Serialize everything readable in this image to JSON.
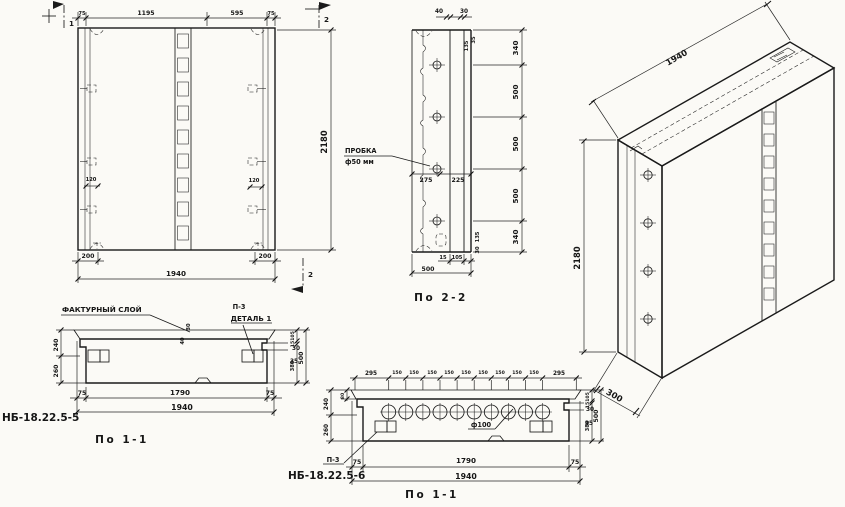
{
  "front_view": {
    "dims_top": [
      "75",
      "1195",
      "595",
      "75"
    ],
    "height": "2180",
    "dim_200_left": "200",
    "dim_total": "1940",
    "dim_200_right": "200",
    "dim_120_left": "120",
    "dim_120_right": "120",
    "flag_1": "1",
    "flag_2_top": "2",
    "flag_2_bottom": "2"
  },
  "section_2_2": {
    "title": "По 2-2",
    "dim_40": "40",
    "dim_30": "30",
    "rot_top": [
      "135",
      "35"
    ],
    "dims_right": [
      "340",
      "500",
      "500",
      "500",
      "340"
    ],
    "plug_line1": "ПРОБКА",
    "plug_line2": "ф50 мм",
    "dim_275": "275",
    "dim_225": "225",
    "dim_15": "15",
    "dim_105": "105",
    "dim_500": "500",
    "rot_bottom": [
      "135",
      "30"
    ]
  },
  "iso": {
    "dim_width": "1940",
    "dim_height": "2180",
    "dim_depth": "300"
  },
  "section_a": {
    "mark": "НБ-18.22.5-5",
    "title": "По 1-1",
    "facture_label": "ФАКТУРНЫЙ СЛОЙ",
    "detail_ref": "П-3",
    "detail_label": "ДЕТАЛЬ 1",
    "dim_240": "240",
    "dim_260": "260",
    "rot_30": "30",
    "rot_40": "40",
    "dim_r30": "30",
    "dim_r35": "35",
    "col": [
      "105",
      "15",
      "380"
    ],
    "col_total": "500",
    "dims_bottom": [
      "75",
      "1790",
      "75"
    ],
    "dim_total": "1940"
  },
  "section_b": {
    "mark": "НБ-18.22.5-6",
    "title": "По 1-1",
    "detail_ref": "П-3",
    "void_label": "ф100",
    "dims_top": [
      "295",
      "150",
      "150",
      "150",
      "150",
      "150",
      "150",
      "150",
      "150",
      "150",
      "295"
    ],
    "dim_240": "240",
    "dim_80": "80",
    "dim_260": "260",
    "dim_r30": "30",
    "dim_r35": "35",
    "col": [
      "105",
      "15",
      "380"
    ],
    "col_total": "500",
    "dims_bottom": [
      "75",
      "1790",
      "75"
    ],
    "dim_total": "1940"
  }
}
